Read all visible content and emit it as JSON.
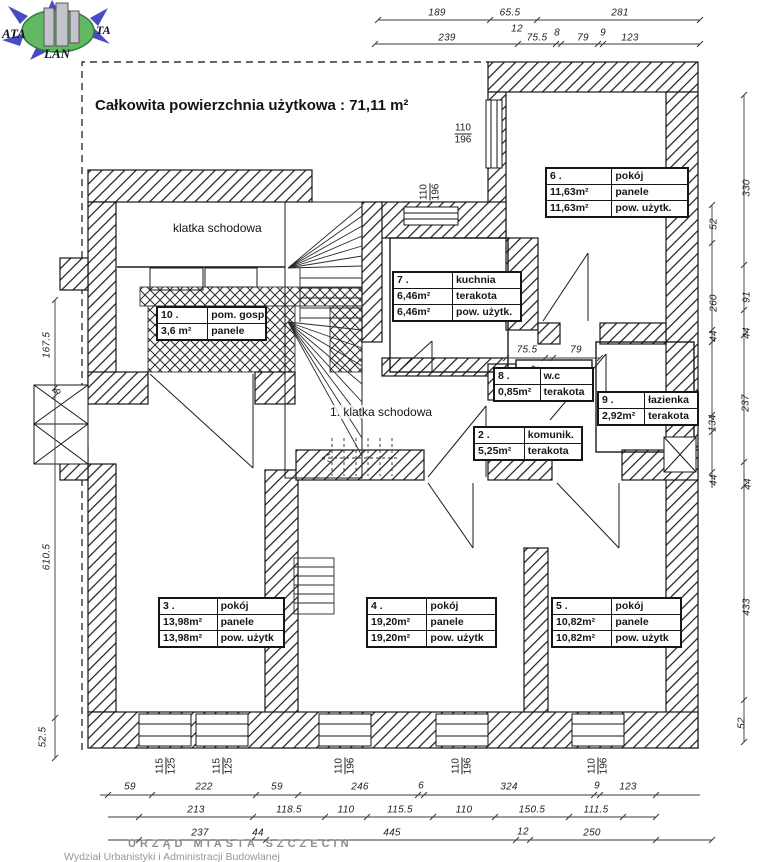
{
  "logo": {
    "text_left": "ATA",
    "text_right": "TA",
    "text_bottom": "LAN",
    "arrow_color": "#4a4ac4",
    "globe_color": "#63b863",
    "building_color": "#c3c3cd"
  },
  "title": "Całkowita powierzchnia użytkowa : 71,11 m²",
  "plan_labels": {
    "staircase_upper": "klatka schodowa",
    "staircase_main": "1. klatka schodowa"
  },
  "rooms": {
    "r6": {
      "num": "6 .",
      "name": "pokój",
      "rows": [
        [
          "11,63m²",
          "panele"
        ],
        [
          "11,63m²",
          "pow. użytk."
        ]
      ]
    },
    "r7": {
      "num": "7 .",
      "name": "kuchnia",
      "rows": [
        [
          "6,46m²",
          "terakota"
        ],
        [
          "6,46m²",
          "pow. użytk."
        ]
      ]
    },
    "r10": {
      "num": "10 .",
      "name": "pom. gosp.",
      "rows": [
        [
          "3,6 m²",
          "panele"
        ]
      ]
    },
    "r8": {
      "num": "8 .",
      "name": "w.c",
      "rows": [
        [
          "0,85m²",
          "terakota"
        ]
      ]
    },
    "r9": {
      "num": "9 .",
      "name": "łazienka",
      "rows": [
        [
          "2,92m²",
          "terakota"
        ]
      ]
    },
    "r2": {
      "num": "2 .",
      "name": "komunik.",
      "rows": [
        [
          "5,25m²",
          "terakota"
        ]
      ]
    },
    "r3": {
      "num": "3 .",
      "name": "pokój",
      "rows": [
        [
          "13,98m²",
          "panele"
        ],
        [
          "13,98m²",
          "pow. użytk"
        ]
      ]
    },
    "r4": {
      "num": "4 .",
      "name": "pokój",
      "rows": [
        [
          "19,20m²",
          "panele"
        ],
        [
          "19,20m²",
          "pow. użytk"
        ]
      ]
    },
    "r5": {
      "num": "5 .",
      "name": "pokój",
      "rows": [
        [
          "10,82m²",
          "panele"
        ],
        [
          "10,82m²",
          "pow. użytk"
        ]
      ]
    }
  },
  "stamp": {
    "line1": "URZĄD MIASTA SZCZECIN",
    "line2": "Wydział Urbanistyki i Administracji Budowlanej"
  },
  "dim_labels": [
    {
      "t": "189",
      "x": 437,
      "y": 13
    },
    {
      "t": "65.5",
      "x": 510,
      "y": 13
    },
    {
      "t": "281",
      "x": 620,
      "y": 13
    },
    {
      "t": "12",
      "x": 517,
      "y": 29
    },
    {
      "t": "239",
      "x": 447,
      "y": 38
    },
    {
      "t": "75.5",
      "x": 537,
      "y": 38
    },
    {
      "t": "8",
      "x": 557,
      "y": 33
    },
    {
      "t": "79",
      "x": 583,
      "y": 38
    },
    {
      "t": "9",
      "x": 603,
      "y": 33
    },
    {
      "t": "123",
      "x": 630,
      "y": 38
    },
    {
      "t": "75.5",
      "x": 527,
      "y": 350
    },
    {
      "t": "79",
      "x": 576,
      "y": 350
    },
    {
      "t": "12",
      "x": 536,
      "y": 371,
      "r": 1
    },
    {
      "t": "167.5",
      "x": 47,
      "y": 345,
      "r": 1
    },
    {
      "t": "8",
      "x": 58,
      "y": 391,
      "r": 1
    },
    {
      "t": "610.5",
      "x": 47,
      "y": 557,
      "r": 1
    },
    {
      "t": "52.5",
      "x": 43,
      "y": 737,
      "r": 1
    },
    {
      "t": "52",
      "x": 714,
      "y": 224,
      "r": 1
    },
    {
      "t": "260",
      "x": 714,
      "y": 303,
      "r": 1
    },
    {
      "t": "44",
      "x": 714,
      "y": 336,
      "r": 1
    },
    {
      "t": "134",
      "x": 713,
      "y": 423,
      "r": 1
    },
    {
      "t": "44",
      "x": 714,
      "y": 480,
      "r": 1
    },
    {
      "t": "330",
      "x": 747,
      "y": 188,
      "r": 1
    },
    {
      "t": "91",
      "x": 747,
      "y": 297,
      "r": 1
    },
    {
      "t": "44",
      "x": 747,
      "y": 333,
      "r": 1
    },
    {
      "t": "237",
      "x": 746,
      "y": 403,
      "r": 1
    },
    {
      "t": "44",
      "x": 748,
      "y": 484,
      "r": 1
    },
    {
      "t": "433",
      "x": 747,
      "y": 607,
      "r": 1
    },
    {
      "t": "52",
      "x": 742,
      "y": 723,
      "r": 1
    },
    {
      "t": "59",
      "x": 130,
      "y": 787
    },
    {
      "t": "222",
      "x": 204,
      "y": 787
    },
    {
      "t": "59",
      "x": 277,
      "y": 787
    },
    {
      "t": "246",
      "x": 360,
      "y": 787
    },
    {
      "t": "6",
      "x": 421,
      "y": 786
    },
    {
      "t": "324",
      "x": 509,
      "y": 787
    },
    {
      "t": "9",
      "x": 597,
      "y": 786
    },
    {
      "t": "123",
      "x": 628,
      "y": 787
    },
    {
      "t": "213",
      "x": 196,
      "y": 810
    },
    {
      "t": "118.5",
      "x": 289,
      "y": 810
    },
    {
      "t": "110",
      "x": 346,
      "y": 810
    },
    {
      "t": "115.5",
      "x": 400,
      "y": 810
    },
    {
      "t": "110",
      "x": 464,
      "y": 810
    },
    {
      "t": "150.5",
      "x": 532,
      "y": 810
    },
    {
      "t": "111.5",
      "x": 596,
      "y": 810
    },
    {
      "t": "237",
      "x": 200,
      "y": 833
    },
    {
      "t": "44",
      "x": 258,
      "y": 833
    },
    {
      "t": "445",
      "x": 392,
      "y": 833
    },
    {
      "t": "12",
      "x": 523,
      "y": 832
    },
    {
      "t": "250",
      "x": 592,
      "y": 833
    }
  ],
  "window_labels": [
    {
      "t": "110",
      "b": "196",
      "x": 463,
      "y": 134,
      "v": 0
    },
    {
      "t": "110",
      "b": "196",
      "x": 430,
      "y": 192,
      "v": 1
    },
    {
      "t": "115",
      "b": "125",
      "x": 166,
      "y": 766,
      "v": 1
    },
    {
      "t": "115",
      "b": "125",
      "x": 223,
      "y": 766,
      "v": 1
    },
    {
      "t": "110",
      "b": "196",
      "x": 345,
      "y": 766,
      "v": 1
    },
    {
      "t": "110",
      "b": "196",
      "x": 462,
      "y": 766,
      "v": 1
    },
    {
      "t": "110",
      "b": "196",
      "x": 598,
      "y": 766,
      "v": 1
    }
  ]
}
